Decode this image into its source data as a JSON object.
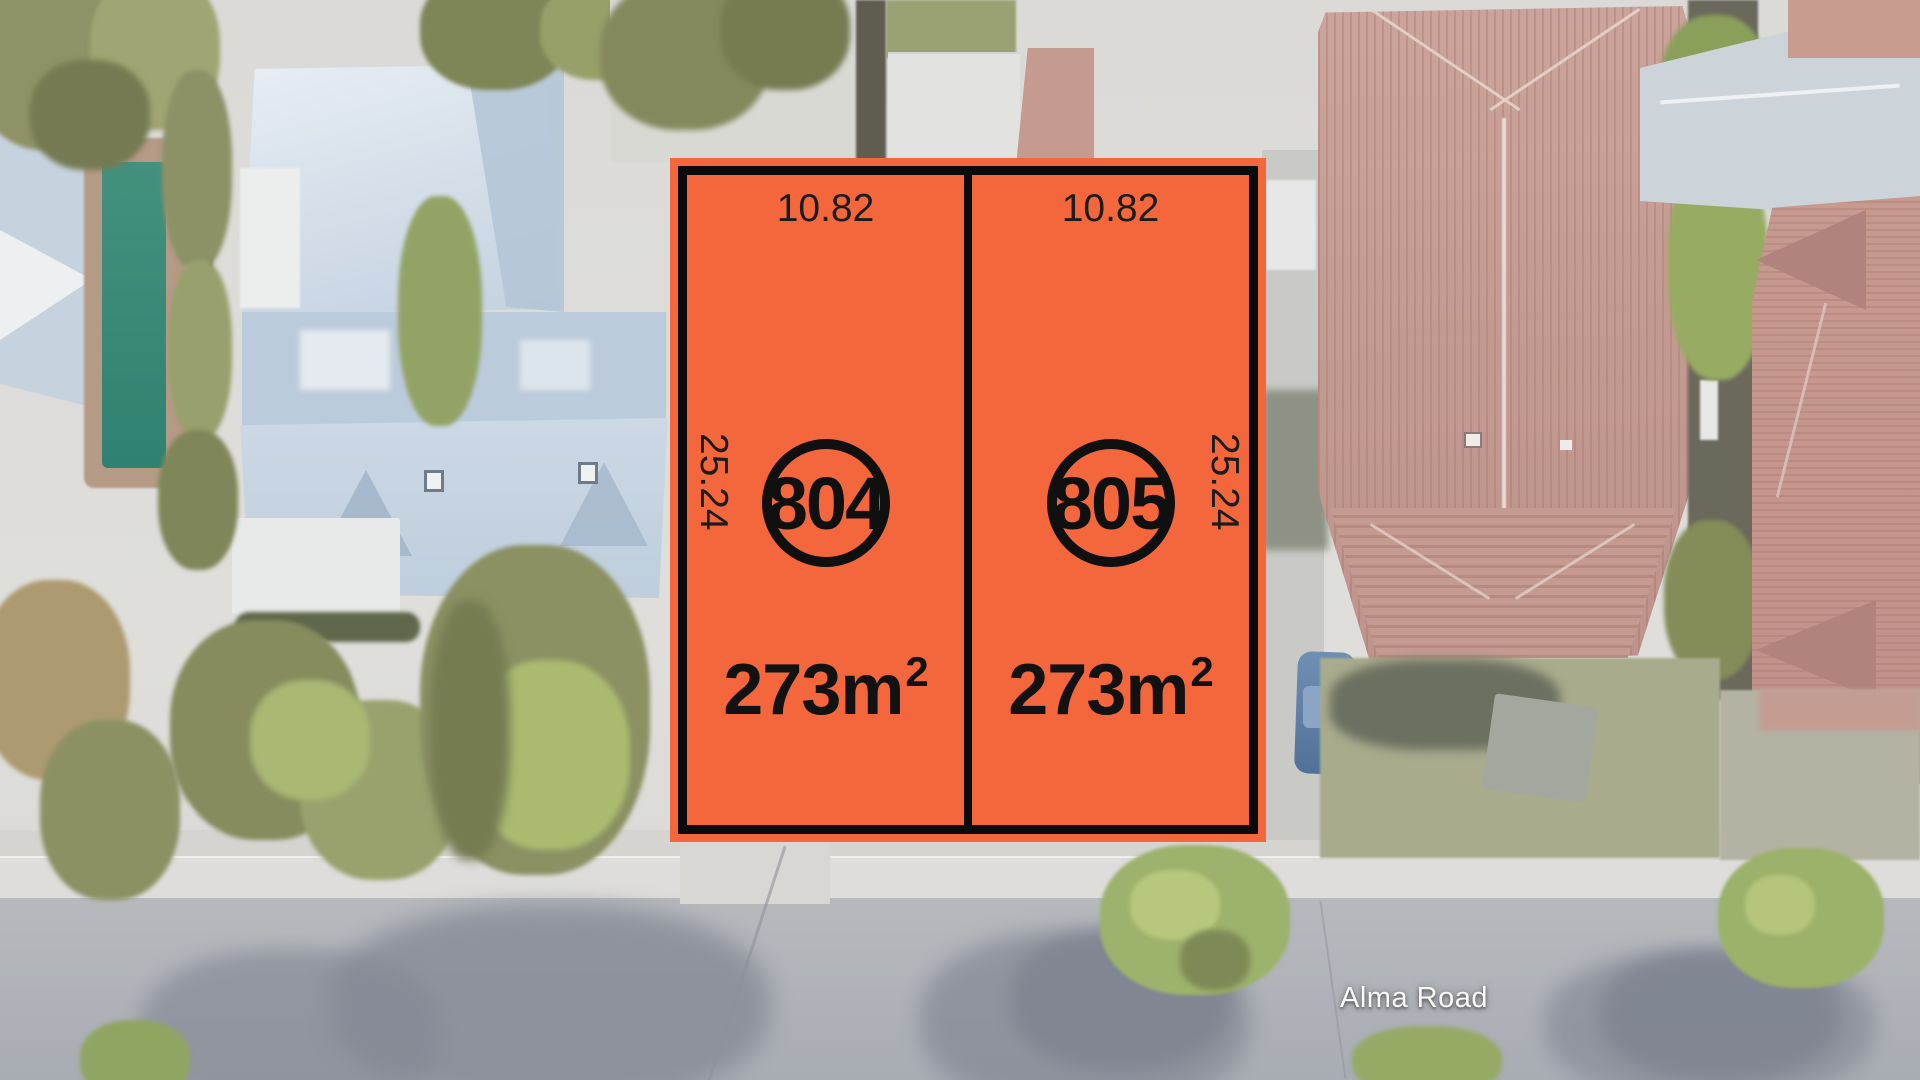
{
  "plan": {
    "lots": [
      {
        "number": "804",
        "frontage": "10.82",
        "depth": "25.24",
        "area_base": "273m",
        "area_sup": "2"
      },
      {
        "number": "805",
        "frontage": "10.82",
        "depth": "25.24",
        "area_base": "273m",
        "area_sup": "2"
      }
    ],
    "colors": {
      "lot_fill": "#F4673C",
      "lot_outline": "#0B0B0B",
      "label_text": "#1C1C1C"
    }
  },
  "map": {
    "road_label": "Alma Road",
    "road_label_color": "#FAF9F6"
  }
}
